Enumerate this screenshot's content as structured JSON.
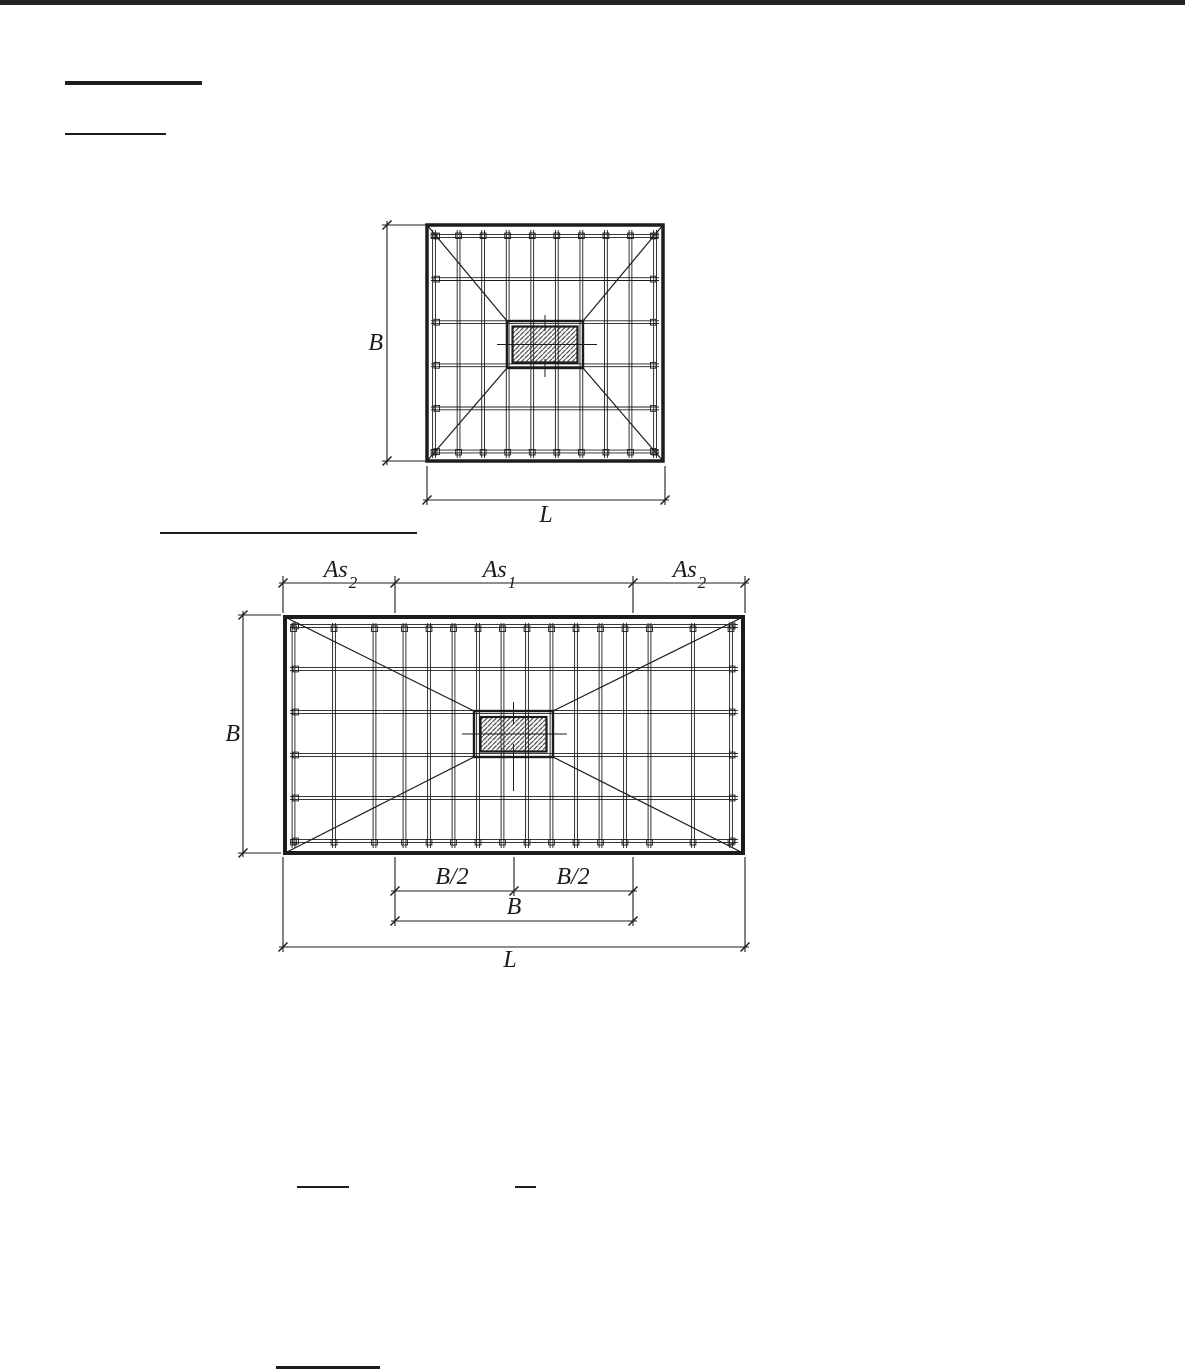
{
  "figure1": {
    "dims": {
      "b": "B",
      "l": "L"
    }
  },
  "figure2": {
    "dims": {
      "b_left": "B",
      "b_half_left": "B/2",
      "b_half_right": "B/2",
      "b_bottom": "B",
      "l_bottom": "L",
      "as2_left": {
        "base": "As",
        "sub": "2"
      },
      "as1": {
        "base": "As",
        "sub": "1"
      },
      "as2_right": {
        "base": "As",
        "sub": "2"
      }
    }
  },
  "colors": {
    "line": "#1c1c1c",
    "hatch": "#3f3f3f",
    "topbar": "#232323",
    "background": "#ffffff"
  }
}
